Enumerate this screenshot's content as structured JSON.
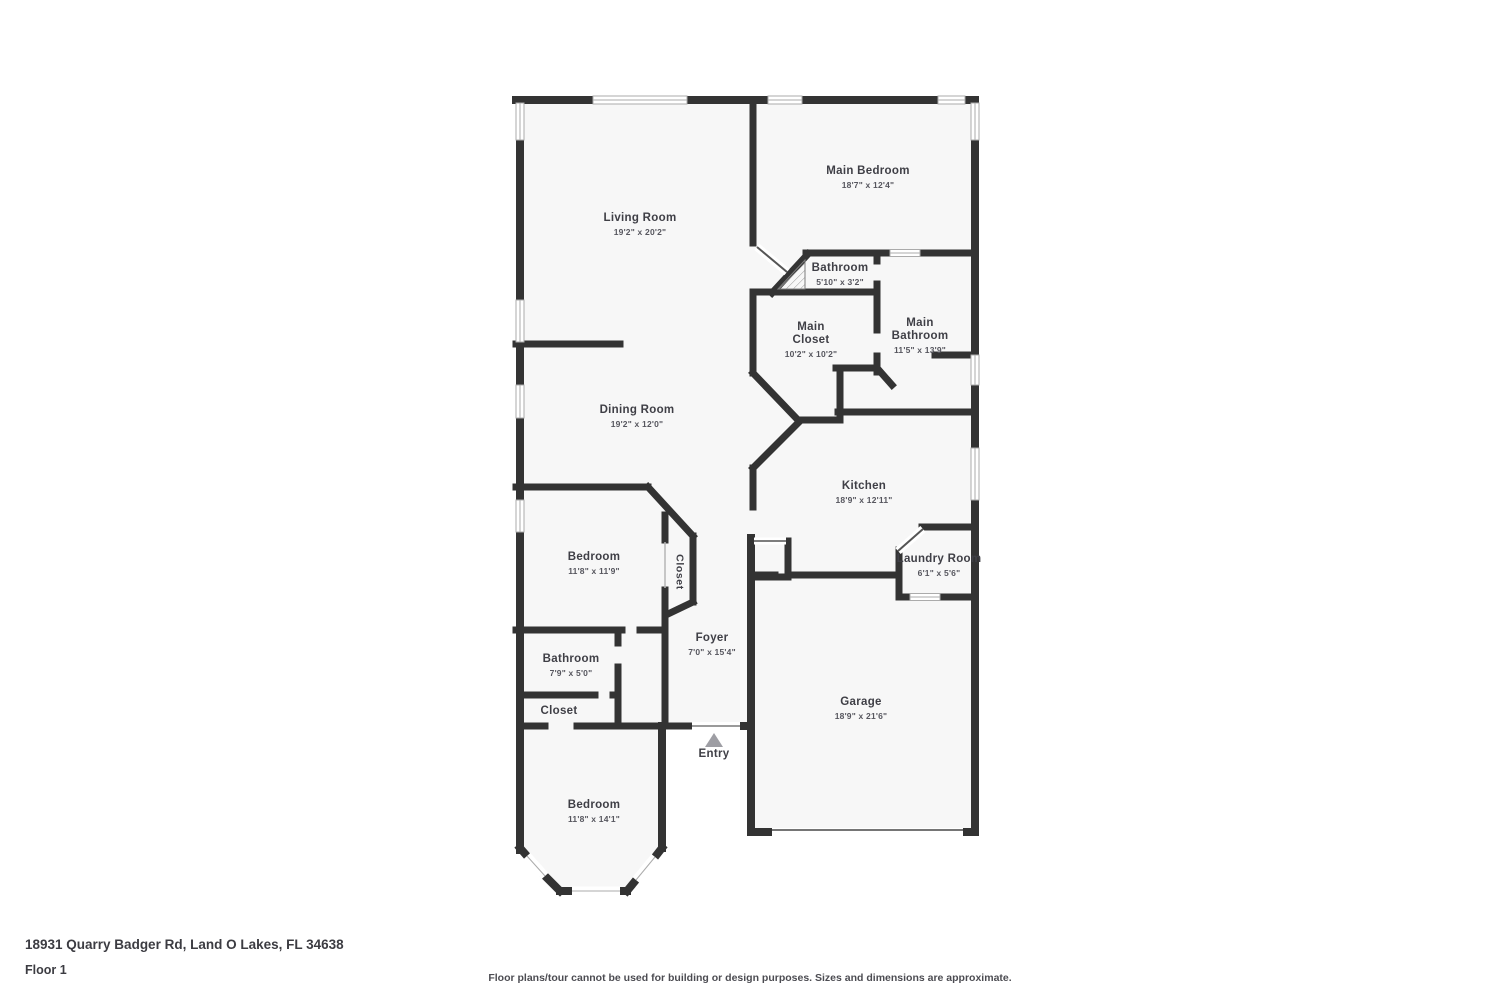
{
  "floor_plan": {
    "rooms": {
      "living_room": {
        "name": "Living Room",
        "dims": "19'2\" x 20'2\""
      },
      "main_bedroom": {
        "name": "Main Bedroom",
        "dims": "18'7\" x 12'4\""
      },
      "bathroom_suite": {
        "name": "Bathroom",
        "dims": "5'10\" x 3'2\""
      },
      "main_closet": {
        "name_line1": "Main",
        "name_line2": "Closet",
        "dims": "10'2\" x 10'2\""
      },
      "main_bathroom": {
        "name_line1": "Main",
        "name_line2": "Bathroom",
        "dims": "11'5\" x 13'9\""
      },
      "dining_room": {
        "name": "Dining Room",
        "dims": "19'2\" x 12'0\""
      },
      "kitchen": {
        "name": "Kitchen",
        "dims": "18'9\" x 12'11\""
      },
      "bedroom_middle": {
        "name": "Bedroom",
        "dims": "11'8\" x 11'9\""
      },
      "closet_middle": {
        "name": "Closet"
      },
      "laundry_room": {
        "name": "Laundry Room",
        "dims": "6'1\" x 5'6\""
      },
      "foyer": {
        "name": "Foyer",
        "dims": "7'0\" x 15'4\""
      },
      "bathroom_hall": {
        "name": "Bathroom",
        "dims": "7'9\" x 5'0\""
      },
      "closet_hall": {
        "name": "Closet"
      },
      "garage": {
        "name": "Garage",
        "dims": "18'9\" x 21'6\""
      },
      "bedroom_front": {
        "name": "Bedroom",
        "dims": "11'8\" x 14'1\""
      },
      "entry": {
        "name": "Entry"
      }
    },
    "colors": {
      "wall": "#333333",
      "floor": "#f7f7f7",
      "window_fill": "#ffffff",
      "window_border": "#ababab",
      "entry_arrow": "#9e9ea4"
    }
  },
  "footer": {
    "address": "18931 Quarry Badger Rd, Land O Lakes, FL 34638",
    "floor_label": "Floor 1",
    "disclaimer": "Floor plans/tour cannot be used for building or design purposes. Sizes and dimensions are approximate."
  }
}
